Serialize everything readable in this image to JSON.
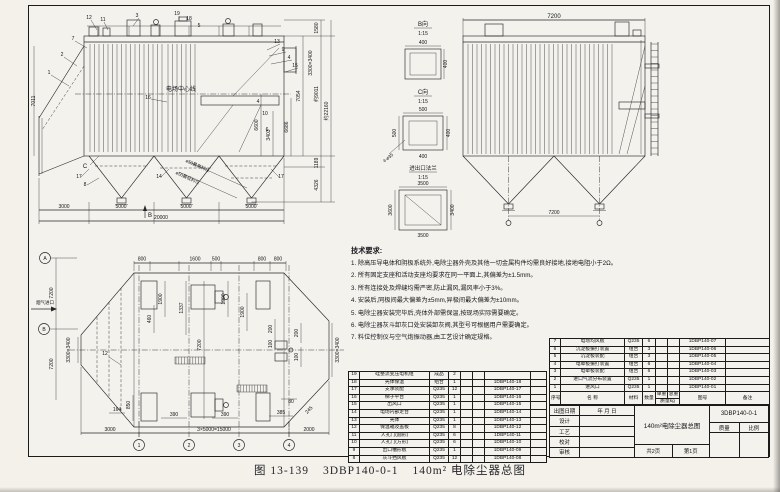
{
  "colors": {
    "paper": "#f4f2ec",
    "ink": "#1b1b1b"
  },
  "caption": {
    "fig": "图 13-139",
    "code": "3DBP140-0-1",
    "title": "140m² 电除尘器总图"
  },
  "tech": {
    "title": "技术要求:",
    "items": [
      "1. 除高压导电体和阴极系统外,电除尘器外壳及其他一切金属构件均需良好接地,接地电阻小于2Ω。",
      "2. 所有固定支座和活动支座均要求在同一平面上,其偏差为±1.5mm。",
      "3. 所有连接处及焊缝均需严密,防止漏风,漏风率小于3%。",
      "4. 安装后,同极间最大偏差为±5mm,异极间最大偏差为±10mm。",
      "5. 电除尘器安装完毕后,壳体外部需保温,按现场实际需要确定。",
      "6. 电除尘器灰斗卸灰口处安装卸灰阀,其型号可根据用户需要确定。",
      "7. 料位控制仪与空气炮振动器,由工艺设计确定规格。"
    ]
  },
  "side_view": {
    "centerline": "电场中心线",
    "level_high": "ø50最高料位",
    "level_low": "ø50最低料位",
    "view_b": "B",
    "view_c": "C",
    "dims_bottom": [
      "3000",
      "5000",
      "5000",
      "5000",
      "20000"
    ],
    "dims_right": [
      "1580",
      "约9011",
      "1189",
      "4326",
      "约22160"
    ],
    "dims_inner": [
      "6600",
      "3403",
      "6686",
      "7054"
    ],
    "dim_outlet_flange": "3300×3400",
    "dim_left": "7011",
    "ref_labels": [
      "1",
      "2",
      "3",
      "4",
      "5",
      "6",
      "7",
      "8",
      "9",
      "10",
      "11",
      "12",
      "13",
      "14",
      "15",
      "16",
      "17",
      "18",
      "19"
    ]
  },
  "end_view": {
    "dim_top": "7200",
    "dim_hopper": "7200"
  },
  "details": {
    "b": {
      "name": "B向",
      "scale": "1:15",
      "top": "400",
      "right": "400"
    },
    "c": {
      "name": "C向",
      "scale": "1:15",
      "top": "500",
      "left": "500",
      "right": "400",
      "bottom": "400",
      "holes": "4-ø35"
    },
    "flange": {
      "name": "进出口法兰",
      "scale": "1:15",
      "top": "3500",
      "left": "3600",
      "right": "3400",
      "bottom": "3500"
    }
  },
  "plan_view": {
    "inlet": "烟气进口",
    "axis_rows": [
      "A",
      "B"
    ],
    "axis_cols": [
      "1",
      "2",
      "3",
      "4"
    ],
    "ref": "12",
    "dims_left": [
      "7200",
      "7200"
    ],
    "dim_left_flange": "3300×3400",
    "dim_right_flange": "3300×3400",
    "dims_top": [
      "800",
      "1600",
      "500",
      "800",
      "800"
    ],
    "dims_1900": [
      "1900",
      "1900",
      "1900"
    ],
    "dims_mid": [
      "7200",
      "1337",
      "460"
    ],
    "dims_cluster": [
      "200",
      "100",
      "200",
      "100",
      "80",
      "245"
    ],
    "dims_bottom_small": [
      "164",
      "850",
      "390",
      "390",
      "385"
    ],
    "dims_bottom": [
      "3000",
      "3×5000=15000",
      "2000"
    ]
  },
  "parts_left": {
    "rows": [
      {
        "no": "19",
        "name": "硅整流变压电机组",
        "mat": "成品",
        "qty": "2",
        "dwg": ""
      },
      {
        "no": "18",
        "name": "壳体保温",
        "mat": "组合",
        "qty": "1",
        "dwg": "1DBP140-18"
      },
      {
        "no": "17",
        "name": "支承装配",
        "mat": "Q235",
        "qty": "12",
        "dwg": "1DBP140-17"
      },
      {
        "no": "16",
        "name": "梯子平台",
        "mat": "Q235",
        "qty": "1",
        "dwg": "1DBP140-16"
      },
      {
        "no": "15",
        "name": "出风口",
        "mat": "Q235",
        "qty": "1",
        "dwg": "1DBP140-15"
      },
      {
        "no": "14",
        "name": "电场内部走台",
        "mat": "Q235",
        "qty": "1",
        "dwg": "1DBP140-14"
      },
      {
        "no": "13",
        "name": "壳体",
        "mat": "Q235",
        "qty": "1",
        "dwg": "1DBP140-13"
      },
      {
        "no": "12",
        "name": "保温箱及盖板",
        "mat": "Q235",
        "qty": "8",
        "dwg": "1DBP140-12"
      },
      {
        "no": "11",
        "name": "人孔门(圆形)",
        "mat": "Q235",
        "qty": "6",
        "dwg": "1DBP140-11"
      },
      {
        "no": "10",
        "name": "人孔门(方形)",
        "mat": "Q235",
        "qty": "6",
        "dwg": "1DBP140-10"
      },
      {
        "no": "9",
        "name": "出口槽形板",
        "mat": "Q235",
        "qty": "1",
        "dwg": "1DBP140-09"
      },
      {
        "no": "8",
        "name": "灰斗挡风板",
        "mat": "Q235",
        "qty": "12",
        "dwg": "1DBP140-08"
      }
    ]
  },
  "parts_right": {
    "rows": [
      {
        "no": "7",
        "name": "电场均风板",
        "mat": "Q235",
        "qty": "6",
        "dwg": "1DBP140-07"
      },
      {
        "no": "6",
        "name": "沉淀极振打装置",
        "mat": "组合",
        "qty": "3",
        "dwg": "1DBP140-06"
      },
      {
        "no": "5",
        "name": "沉淀极装配",
        "mat": "组合",
        "qty": "3",
        "dwg": "1DBP140-05"
      },
      {
        "no": "4",
        "name": "电晕极振打装置",
        "mat": "组合",
        "qty": "6",
        "dwg": "1DBP140-04"
      },
      {
        "no": "3",
        "name": "电晕极装配",
        "mat": "组合",
        "qty": "6",
        "dwg": "1DBP140-03"
      },
      {
        "no": "2",
        "name": "进口气流分布装置",
        "mat": "Q235",
        "qty": "1",
        "dwg": "1DBP140-02"
      },
      {
        "no": "1",
        "name": "进风口",
        "mat": "Q235",
        "qty": "1",
        "dwg": "1DBP140-01"
      }
    ],
    "header": {
      "no": "序号",
      "name": "名  称",
      "mat": "材料",
      "qty": "数量",
      "w1": "单重",
      "w2": "总重",
      "wunit": "质量kg",
      "dwg": "图号",
      "note": "备注"
    },
    "footer": {
      "left": "材 料 表",
      "right": "全重kg"
    }
  },
  "titleblock": {
    "date_label": "出图日期",
    "date_value": "年 月 日",
    "sign_rows": [
      "设计",
      "工艺",
      "校对",
      "审核"
    ],
    "title": "140m²电除尘器总图",
    "pages": "共2页",
    "page_no": "第1页",
    "dwg_no": "3DBP140-0-1",
    "mass_label": "质量",
    "scale_label": "比例"
  }
}
